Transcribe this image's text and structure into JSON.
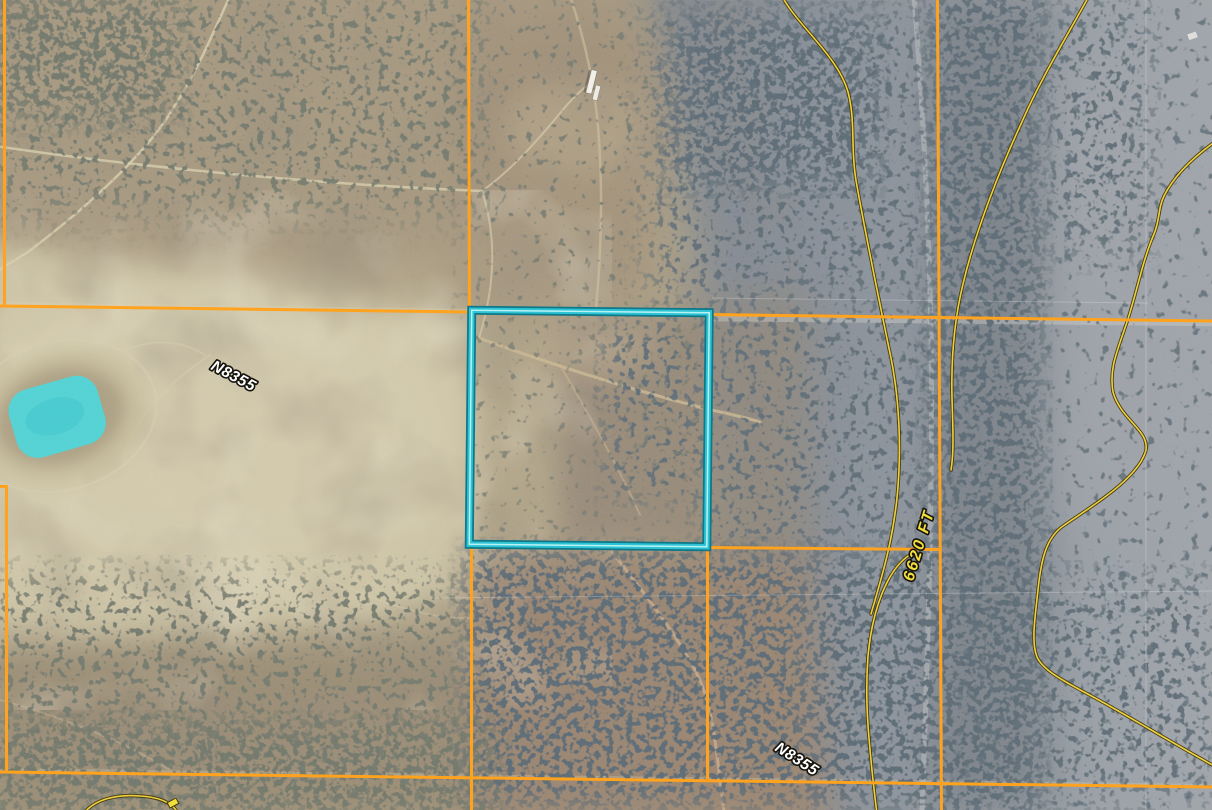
{
  "map": {
    "road_labels": [
      {
        "text": "N8355",
        "position": "upper-left"
      },
      {
        "text": "N8355",
        "position": "lower-right"
      }
    ],
    "contour_label": {
      "text": "6620 FT",
      "elevation_ft": 6620
    },
    "colors": {
      "parcel_line": "#FFA21E",
      "highlight_parcel_stroke": "#2CC4D4",
      "highlight_parcel_dark_edge": "#0F7787",
      "highlight_parcel_core": "#B9F1F5",
      "contour_line": "#EDD143",
      "contour_label_fill": "#F2DE3A",
      "water_highlight": "#4ED7DA",
      "road_label_fill": "#FFFFFF"
    }
  }
}
